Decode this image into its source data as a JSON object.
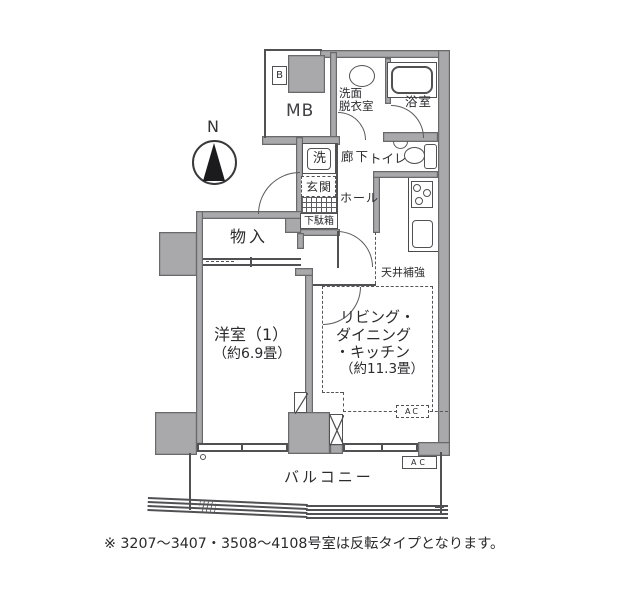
{
  "floor_plan": {
    "compass": "N",
    "labels": {
      "meter_box": "MB",
      "b_mark": "B",
      "washroom_line1": "洗面",
      "washroom_line2": "脱衣室",
      "bathroom": "浴室",
      "corridor": "廊下",
      "toilet": "トイレ",
      "washer": "洗",
      "entrance": "玄関",
      "hall": "ホール",
      "shoe_cabinet": "下駄箱",
      "storage": "物入",
      "western_room_name": "洋室（1）",
      "western_room_area": "（約6.9畳）",
      "ldk_line1": "リビング・",
      "ldk_line2": "ダイニング",
      "ldk_line3": "・キッチン",
      "ldk_area": "（約11.3畳）",
      "ceiling_reinforcement": "天井補強",
      "balcony": "バルコニー",
      "ac_unit_indoor": "AC",
      "ac_unit_balcony": "AC"
    },
    "icons": {
      "compass": "north-arrow-in-circle",
      "bathtub": "rounded-tub-outline",
      "basin": "oval-basin",
      "toilet": "toilet-bowl-with-tank",
      "stove": "three-burner-stove",
      "kitchen_sink": "rounded-rect-sink",
      "shaft": "x-cross-box",
      "sleeve": "diagonal-slash-box"
    },
    "colors": {
      "wall_fill": "#a9a9ab",
      "line": "#515154",
      "text": "#2b2b2e"
    },
    "footnote": "※ 3207～3407・3508～4108号室は反転タイプとなります。"
  }
}
